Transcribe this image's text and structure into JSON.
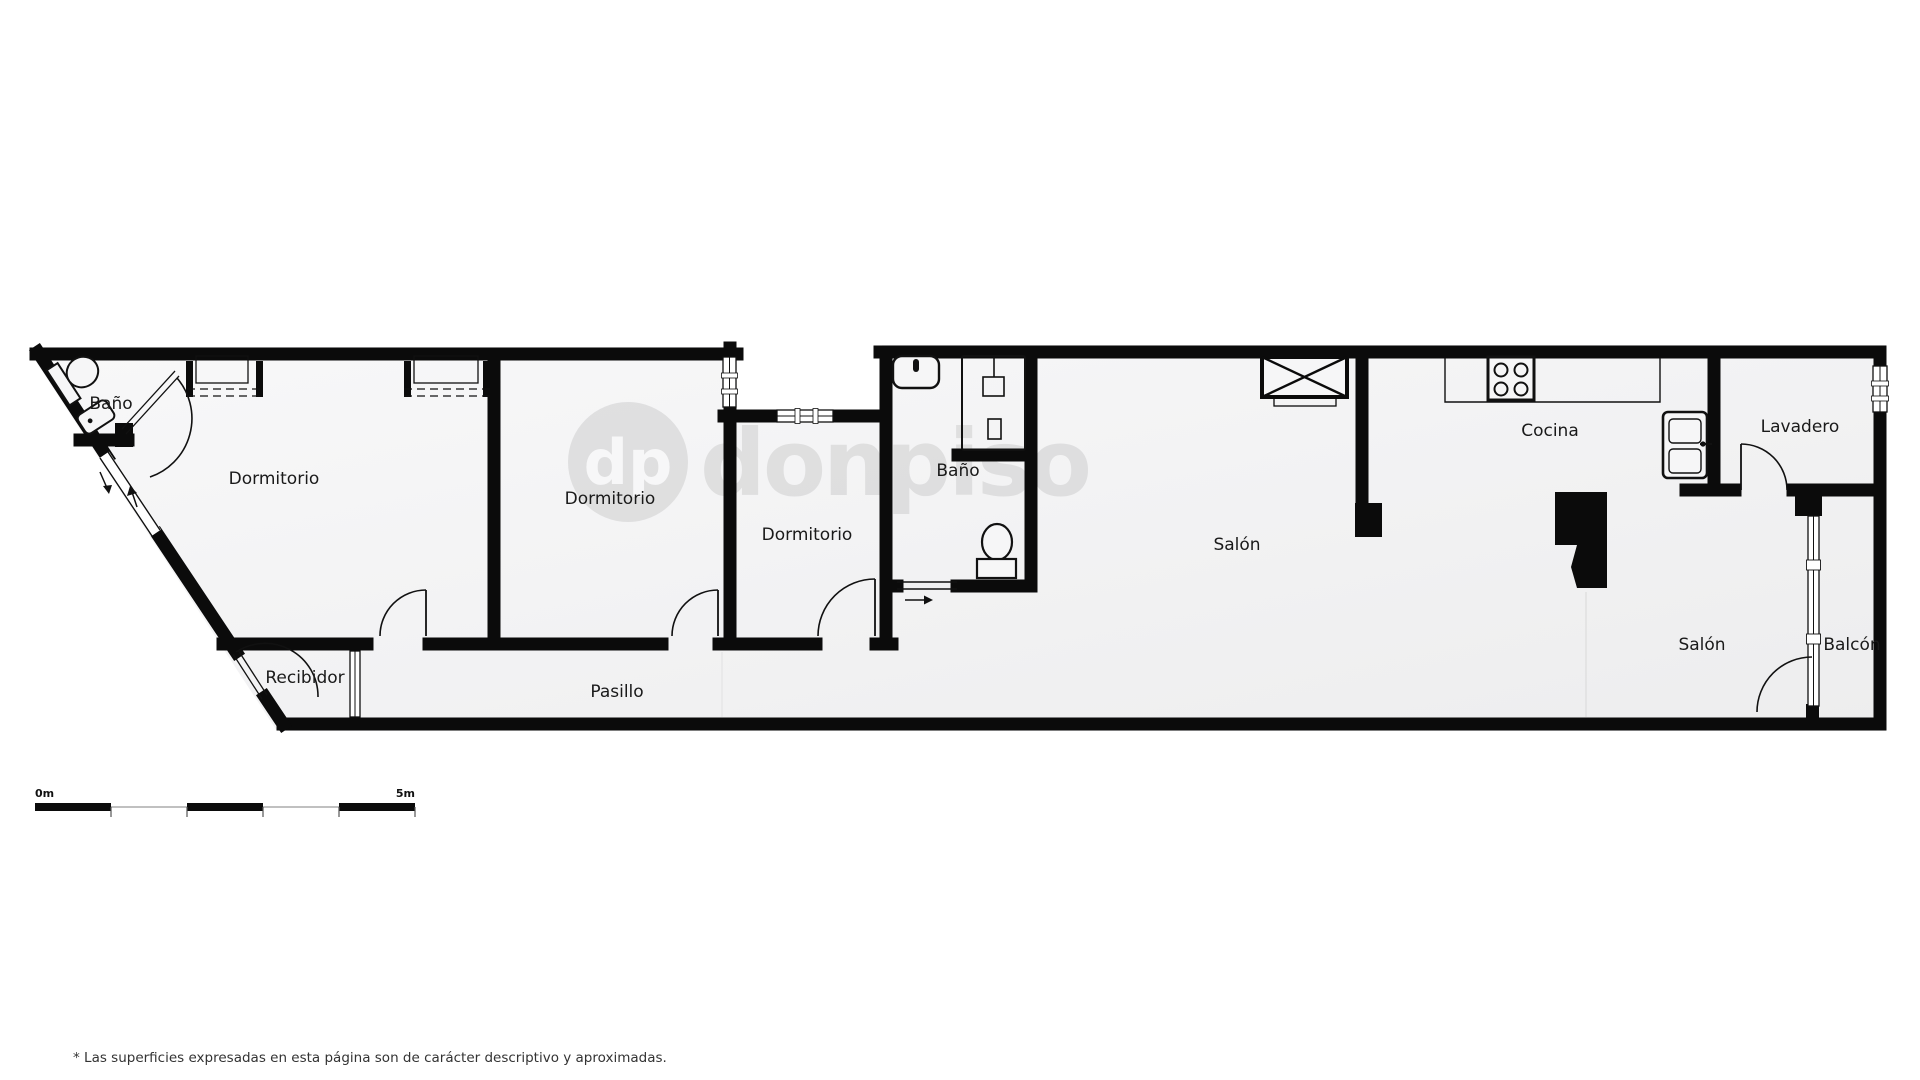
{
  "plan": {
    "rooms": {
      "bano1": "Baño",
      "dormitorio1": "Dormitorio",
      "dormitorio2": "Dormitorio",
      "dormitorio3": "Dormitorio",
      "bano2": "Baño",
      "salon1": "Salón",
      "cocina": "Cocina",
      "lavadero": "Lavadero",
      "salon2": "Salón",
      "balcon": "Balcón",
      "recibidor": "Recibidor",
      "pasillo": "Pasillo"
    },
    "fixtures": {
      "bano1": [
        "toilet",
        "washbasin"
      ],
      "bano2": [
        "washbasin",
        "shower",
        "toilet"
      ],
      "cocina": [
        "counter",
        "stove-4-burners",
        "double-sink"
      ],
      "dormitorio1": [
        "wardrobe",
        "wardrobe"
      ],
      "shaft": "ventilation-shaft-x"
    },
    "watermark": {
      "monogram": "dp",
      "brand": "donpiso"
    },
    "scale_bar": {
      "start": "0m",
      "end": "5m"
    },
    "footnote": "* Las superficies expresadas en esta página son de carácter descriptivo y aproximadas.",
    "colors": {
      "wall": "#0b0b0b",
      "floor_light": "#f8f8f9",
      "floor_dark": "#eeeeef",
      "outside": "#ffffff",
      "label": "#1a1a1a",
      "watermark": "rgba(0,0,0,0.085)"
    }
  }
}
